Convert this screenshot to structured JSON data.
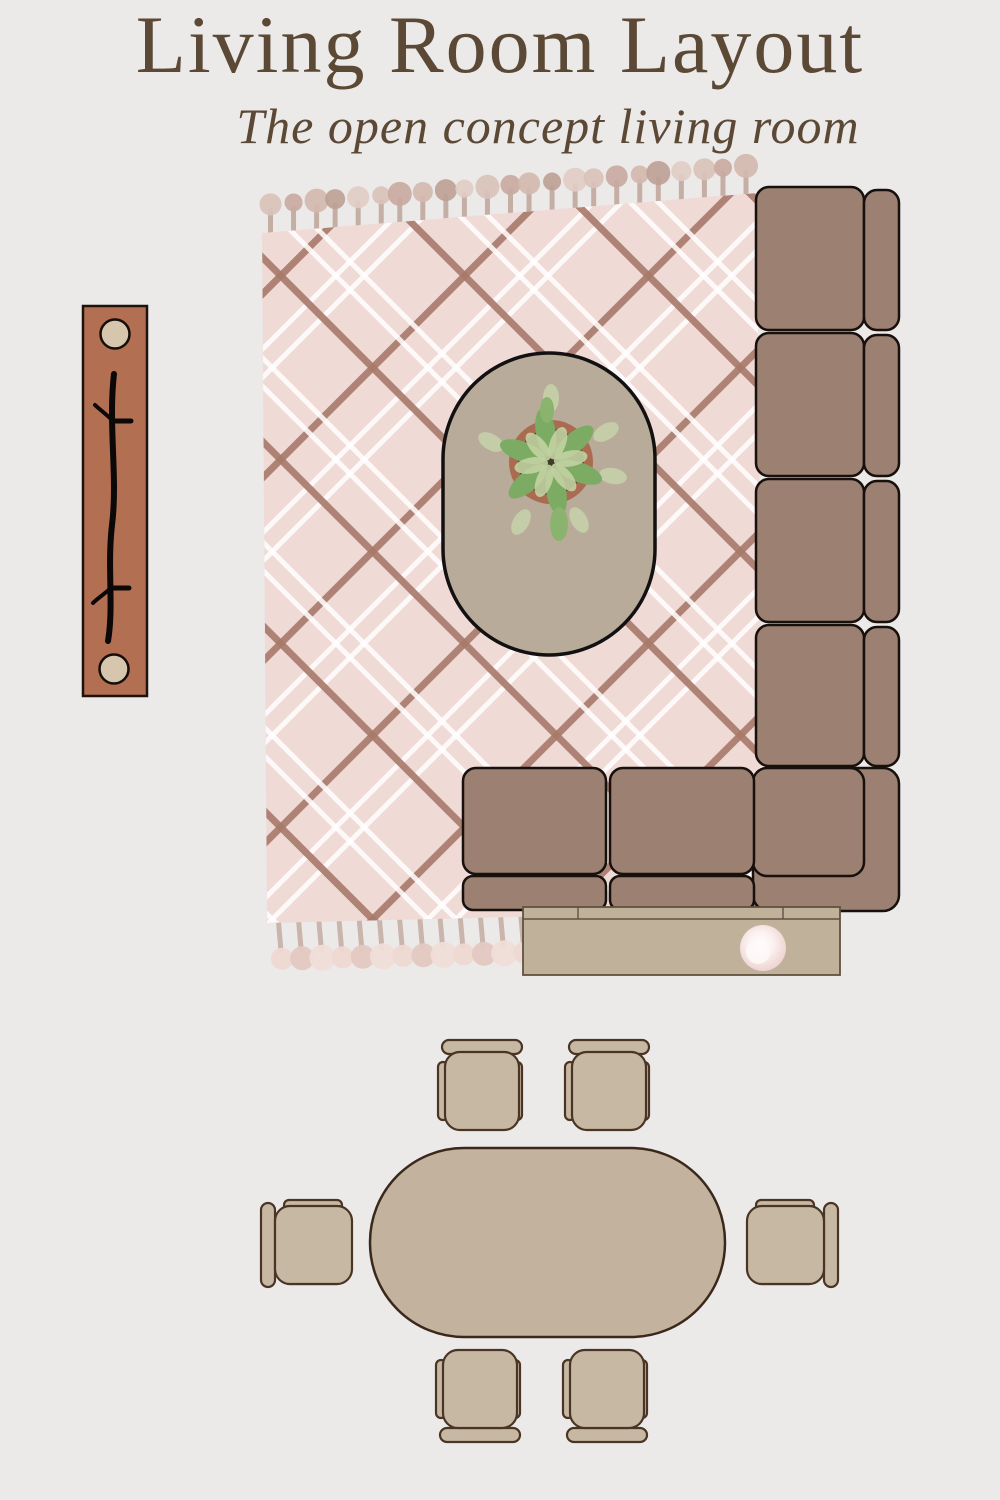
{
  "header": {
    "title": "Living Room Layout",
    "subtitle": "The open concept living room",
    "text_color": "#5B4936"
  },
  "palette": {
    "background": "#ECE9E9",
    "rug_pink": "#EFDAD6",
    "rug_plaid_brown": "#A87969",
    "rug_plaid_white": "#FFFFFF",
    "sofa_brown": "#9C8172",
    "sofa_outline": "#17100C",
    "coffee_table_tan": "#B8AB9A",
    "console_tan": "#C0B19B",
    "sideboard_terracotta": "#B26F52",
    "dining_wood_tan": "#C7B8A4",
    "plant_green": "#7CAB63",
    "plant_light_green": "#C3D2A2",
    "pot_terracotta": "#AA6B51",
    "bowl_pink": "#F3DCDA"
  },
  "furniture": {
    "rug": "plaid-fringe-rug",
    "sofa": "l-shaped-sectional-sofa",
    "sofa_seat_sections": 7,
    "coffee_table": "oval-coffee-table",
    "plant": "potted-plant",
    "sideboard": "terracotta-sideboard",
    "sideboard_decor": "two-round-lamps-and-branch",
    "media_console": "console-table-with-bowl",
    "dining_table": "oval-dining-table",
    "dining_chairs_count": 6
  }
}
